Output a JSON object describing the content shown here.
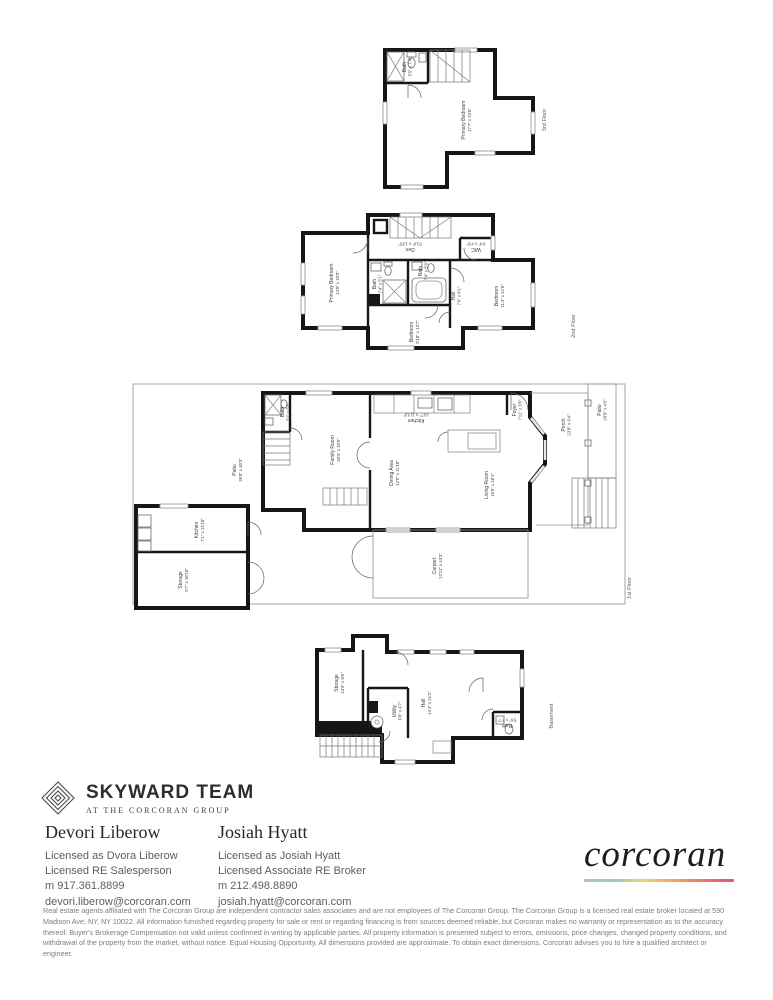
{
  "plans": {
    "floor3": {
      "label": "3rd Floor",
      "rooms": {
        "primary_bedroom": {
          "name": "Primary Bedroom",
          "dims": "17'7\" x 23'0\""
        },
        "bath": {
          "name": "Bath",
          "dims": "5'5\" x 7'4\""
        }
      }
    },
    "floor2": {
      "label": "2nd Floor",
      "rooms": {
        "primary_bedroom": {
          "name": "Primary Bedroom",
          "dims": "14'6\" x 10'9\""
        },
        "den": {
          "name": "Den",
          "dims": "5'10\" x 13'5\""
        },
        "wic": {
          "name": "WIC",
          "dims": "6'4\" x 4'9\""
        },
        "bath_left": {
          "name": "Bath",
          "dims": "7'4\" x 5'1\""
        },
        "bath_center": {
          "name": "Bath",
          "dims": "7'4\" x 5'9\""
        },
        "hall": {
          "name": "Hall",
          "dims": "7'6\" x 8'1\""
        },
        "bedroom_bottom": {
          "name": "Bedroom",
          "dims": "9'10\" x 13'7\""
        },
        "bedroom_right": {
          "name": "Bedroom",
          "dims": "11'4\" x 12'6\""
        }
      }
    },
    "floor1": {
      "label": "1st Floor",
      "rooms": {
        "patio_left": {
          "name": "Patio",
          "dims": "39'8\" x 40'3\""
        },
        "kitchen_annex": {
          "name": "Kitchen",
          "dims": "7'1\" x 14'10\""
        },
        "storage": {
          "name": "Storage",
          "dims": "9'7\" x 18'10\""
        },
        "bath": {
          "name": "Bath",
          "dims": "3'1\" x 6'8\""
        },
        "family_room": {
          "name": "Family Room",
          "dims": "20'3\" x 10'9\""
        },
        "kitchen": {
          "name": "Kitchen",
          "dims": "10'7\" x 11'10\""
        },
        "dining_area": {
          "name": "Dining Area",
          "dims": "12'9\" x 11'10\""
        },
        "living_room": {
          "name": "Living Room",
          "dims": "15'5\" x 18'1\""
        },
        "foyer": {
          "name": "Foyer",
          "dims": "7'11\" x 3'6\""
        },
        "porch": {
          "name": "Porch",
          "dims": "23'8\" x 6'4\""
        },
        "patio_right": {
          "name": "Patio",
          "dims": "26'8\" x 4'9\""
        },
        "carport": {
          "name": "Carport",
          "dims": "12'11\" x 43'3\""
        }
      }
    },
    "basement": {
      "label": "Basement",
      "rooms": {
        "storage": {
          "name": "Storage",
          "dims": "13'9\" x 8'6\""
        },
        "utility": {
          "name": "Utility",
          "dims": "6'8\" x 4'7\""
        },
        "hall": {
          "name": "Hall",
          "dims": "14'4\" x 21'2\""
        },
        "bath": {
          "name": "Bath",
          "dims": "5'6\" x 7'7\""
        }
      }
    }
  },
  "branding": {
    "team_name": "SKYWARD TEAM",
    "team_tagline": "AT THE CORCORAN GROUP",
    "brokerage_wordmark": "corcoran",
    "gradient_colors": [
      "#aebfd4",
      "#9fcbb5",
      "#ead46e",
      "#f3a55b",
      "#ec7566",
      "#e25578"
    ]
  },
  "agents": [
    {
      "name": "Devori Liberow",
      "licensed_as": "Licensed as Dvora Liberow",
      "title": "Licensed RE Salesperson",
      "phone": "m 917.361.8899",
      "email": "devori.liberow@corcoran.com"
    },
    {
      "name": "Josiah Hyatt",
      "licensed_as": "Licensed as Josiah Hyatt",
      "title": "Licensed Associate RE Broker",
      "phone": "m 212.498.8890",
      "email": "josiah.hyatt@corcoran.com"
    }
  ],
  "disclaimer": "Real estate agents affiliated with The Corcoran Group are independent contractor sales associates and are not employees of The Corcoran Group. The Corcoran Group is a licensed real estate broker located at 590 Madison Ave, NY, NY 10022. All information furnished regarding property for sale or rent or regarding financing is from sources deemed reliable, but Corcoran makes no warranty or representation as to the accuracy thereof. Buyer's Brokerage Compensation not valid unless confirmed in writing by applicable parties. All property information is presented subject to errors, omissions, price changes, changed property conditions, and withdrawal of the property from the market, without notice. Equal Housing Opportunity. All dimensions provided are approximate. To obtain exact dimensions, Corcoran advises you to hire a qualified architect or engineer."
}
